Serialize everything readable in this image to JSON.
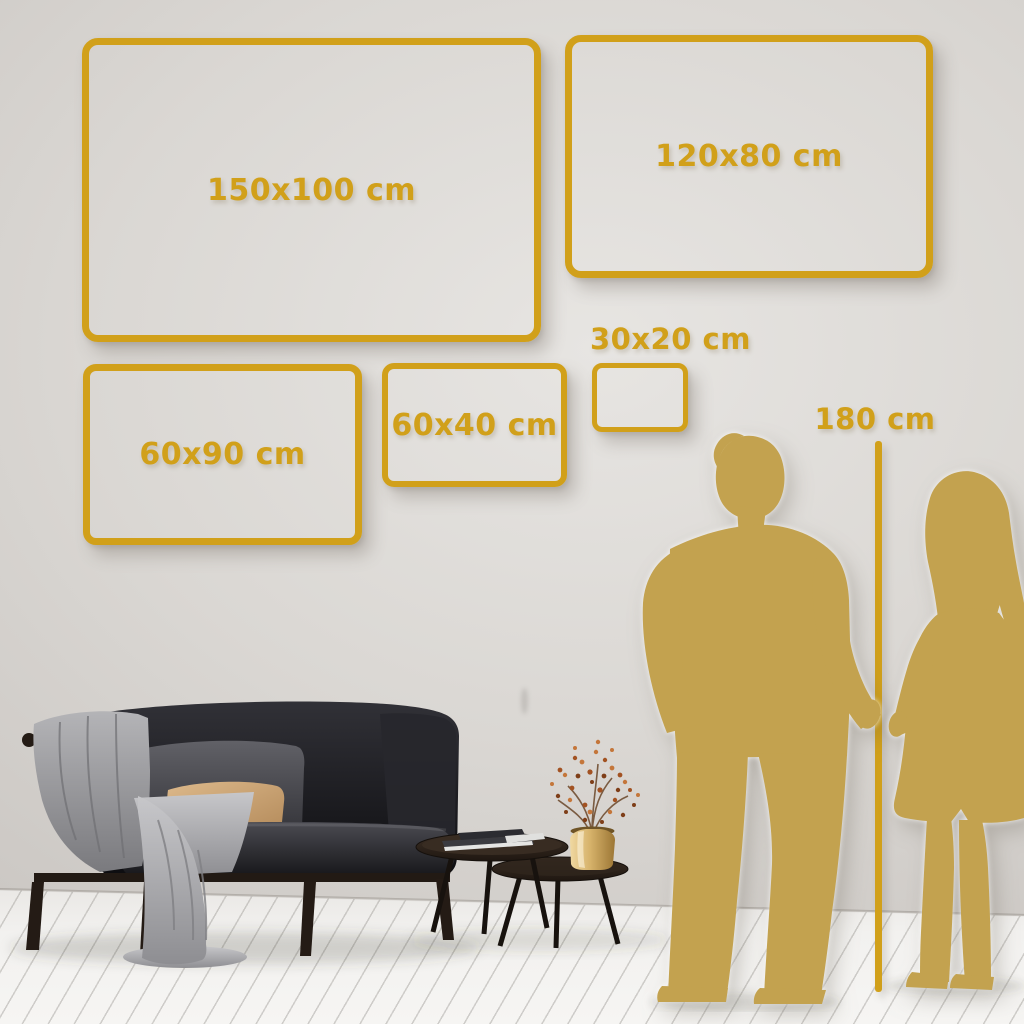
{
  "size_guide": {
    "frames": [
      {
        "label": "150x100 cm"
      },
      {
        "label": "120x80 cm"
      },
      {
        "label": "60x90 cm"
      },
      {
        "label": "60x40 cm"
      },
      {
        "label": "30x20 cm"
      }
    ],
    "height_reference": {
      "label": "180 cm"
    }
  },
  "colors": {
    "gold_accent": "#d1a01a",
    "silhouette_gold": "#c3a24f",
    "wall": "#d8d5d1",
    "floor": "#f1f0ee"
  }
}
